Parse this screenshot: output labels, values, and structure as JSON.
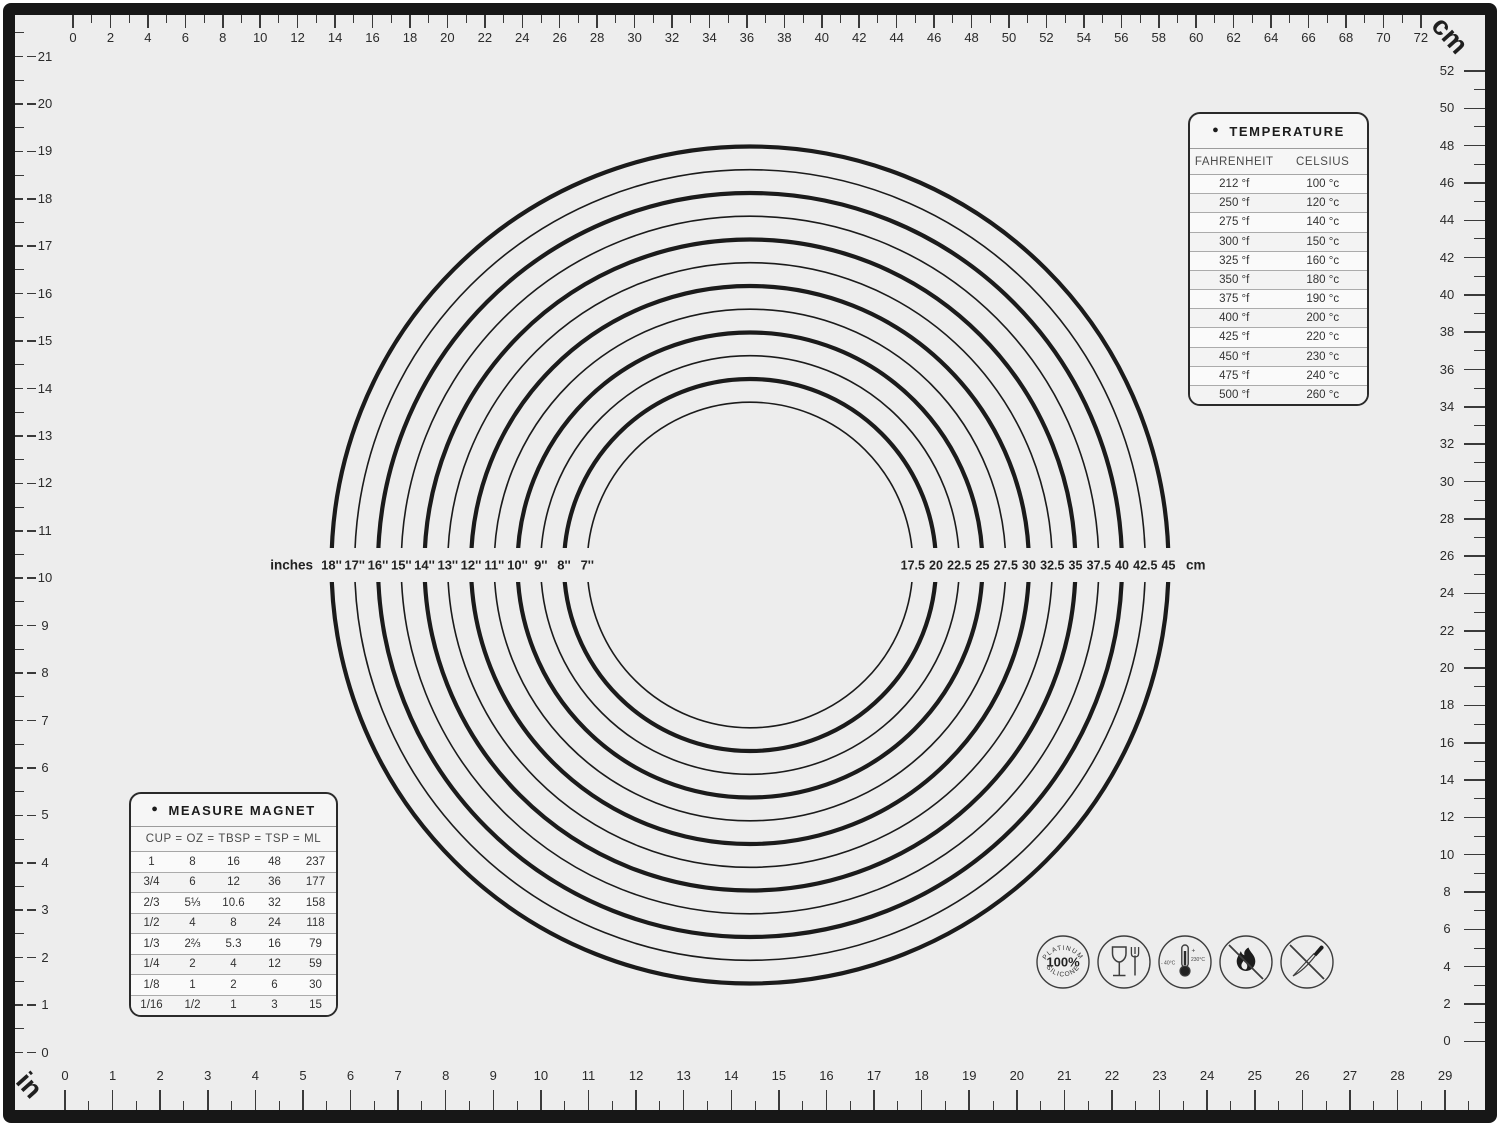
{
  "units": {
    "top_right": "cm",
    "bottom_left": "in"
  },
  "rulers": {
    "top_cm": {
      "values": [
        0,
        2,
        4,
        6,
        8,
        10,
        12,
        14,
        16,
        18,
        20,
        22,
        24,
        26,
        28,
        30,
        32,
        34,
        36,
        38,
        40,
        42,
        44,
        46,
        48,
        50,
        52,
        54,
        56,
        58,
        60,
        62,
        64,
        66,
        68,
        70,
        72
      ]
    },
    "right_cm": {
      "values": [
        52,
        50,
        48,
        46,
        44,
        42,
        40,
        38,
        36,
        34,
        32,
        30,
        28,
        26,
        24,
        22,
        20,
        18,
        16,
        14,
        12,
        10,
        8,
        6,
        4,
        2,
        0
      ]
    },
    "left_in": {
      "values": [
        21,
        20,
        19,
        18,
        17,
        16,
        15,
        14,
        13,
        12,
        11,
        10,
        9,
        8,
        7,
        6,
        5,
        4,
        3,
        2,
        1,
        0
      ]
    },
    "bottom_in": {
      "values": [
        0,
        1,
        2,
        3,
        4,
        5,
        6,
        7,
        8,
        9,
        10,
        11,
        12,
        13,
        14,
        15,
        16,
        17,
        18,
        19,
        20,
        21,
        22,
        23,
        24,
        25,
        26,
        27,
        28,
        29
      ]
    }
  },
  "circles": {
    "left_unit_label": "inches",
    "right_unit_label": "cm",
    "rings": [
      {
        "inches": "18''",
        "cm": "45",
        "diameter_cm": 45,
        "bold": true
      },
      {
        "inches": "17''",
        "cm": "42.5",
        "diameter_cm": 42.5,
        "bold": false
      },
      {
        "inches": "16''",
        "cm": "40",
        "diameter_cm": 40,
        "bold": true
      },
      {
        "inches": "15''",
        "cm": "37.5",
        "diameter_cm": 37.5,
        "bold": false
      },
      {
        "inches": "14''",
        "cm": "35",
        "diameter_cm": 35,
        "bold": true
      },
      {
        "inches": "13''",
        "cm": "32.5",
        "diameter_cm": 32.5,
        "bold": false
      },
      {
        "inches": "12''",
        "cm": "30",
        "diameter_cm": 30,
        "bold": true
      },
      {
        "inches": "11''",
        "cm": "27.5",
        "diameter_cm": 27.5,
        "bold": false
      },
      {
        "inches": "10''",
        "cm": "25",
        "diameter_cm": 25,
        "bold": true
      },
      {
        "inches": "9''",
        "cm": "22.5",
        "diameter_cm": 22.5,
        "bold": false
      },
      {
        "inches": "8''",
        "cm": "20",
        "diameter_cm": 20,
        "bold": true
      },
      {
        "inches": "7''",
        "cm": "17.5",
        "diameter_cm": 17.5,
        "bold": false
      }
    ]
  },
  "temperature_table": {
    "bullet": "●",
    "title": "TEMPERATURE",
    "headers": [
      "FAHRENHEIT",
      "CELSIUS"
    ],
    "rows": [
      [
        "212 °f",
        "100 °c"
      ],
      [
        "250 °f",
        "120 °c"
      ],
      [
        "275 °f",
        "140 °c"
      ],
      [
        "300 °f",
        "150 °c"
      ],
      [
        "325 °f",
        "160 °c"
      ],
      [
        "350 °f",
        "180 °c"
      ],
      [
        "375 °f",
        "190 °c"
      ],
      [
        "400 °f",
        "200 °c"
      ],
      [
        "425 °f",
        "220 °c"
      ],
      [
        "450 °f",
        "230 °c"
      ],
      [
        "475 °f",
        "240 °c"
      ],
      [
        "500 °f",
        "260 °c"
      ]
    ]
  },
  "measure_table": {
    "bullet": "●",
    "title": "MEASURE MAGNET",
    "header": "CUP  =  OZ =  TBSP  =  TSP =  ML",
    "rows": [
      [
        "1",
        "8",
        "16",
        "48",
        "237"
      ],
      [
        "3/4",
        "6",
        "12",
        "36",
        "177"
      ],
      [
        "2/3",
        "5⅓",
        "10.6",
        "32",
        "158"
      ],
      [
        "1/2",
        "4",
        "8",
        "24",
        "118"
      ],
      [
        "1/3",
        "2⅔",
        "5.3",
        "16",
        "79"
      ],
      [
        "1/4",
        "2",
        "4",
        "12",
        "59"
      ],
      [
        "1/8",
        "1",
        "2",
        "6",
        "30"
      ],
      [
        "1/16",
        "1/2",
        "1",
        "3",
        "15"
      ]
    ]
  },
  "icons": {
    "platinum": {
      "arc_top": "PLATINUM",
      "center": "100%",
      "arc_bottom": "SILICONE"
    },
    "temp_range": {
      "left": "- 40°C",
      "plus": "+",
      "right": "230°C"
    }
  },
  "colors": {
    "mat_bg": "#ededed",
    "frame": "#171717",
    "ink": "#1b1b1b",
    "tick": "#3a3a3a"
  }
}
